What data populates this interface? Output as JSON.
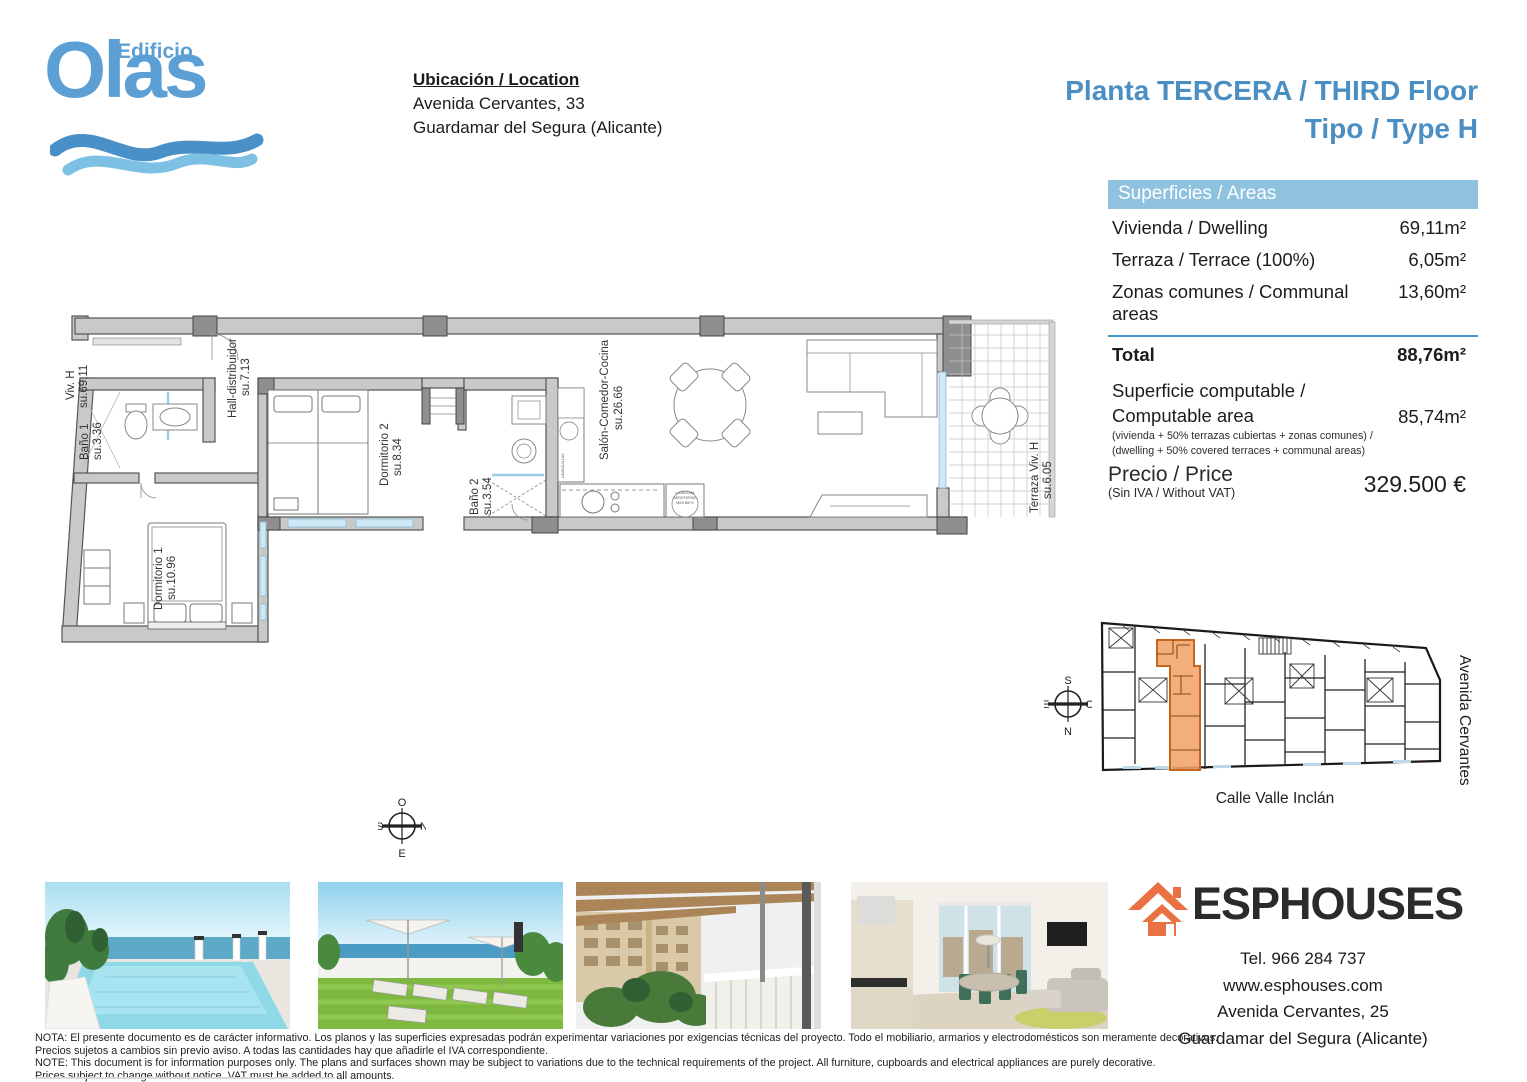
{
  "colors": {
    "accent": "#4a8ec2",
    "table_header": "#8fc2de",
    "divider": "#3f9ac9",
    "orange": "#ea7242",
    "site_highlight": "#f1a469",
    "logo_blue": "#5b9fd4",
    "wave_light": "#7cc0e4"
  },
  "logo": {
    "top": "Edificio",
    "main": "Olas"
  },
  "location": {
    "heading": "Ubicación / Location",
    "line1": "Avenida Cervantes, 33",
    "line2": "Guardamar del Segura (Alicante)"
  },
  "title": {
    "line1": "Planta TERCERA / THIRD Floor",
    "line2": "Tipo / Type H"
  },
  "areas": {
    "header": "Superficies / Areas",
    "rows": [
      {
        "label": "Vivienda / Dwelling",
        "value": "69,11m²"
      },
      {
        "label": "Terraza / Terrace (100%)",
        "value": "6,05m²"
      },
      {
        "label": "Zonas comunes / Communal areas",
        "value": "13,60m²"
      }
    ],
    "total": {
      "label": "Total",
      "value": "88,76m²"
    },
    "computable": {
      "label1": "Superficie computable /",
      "label2": "Computable area",
      "note1": "(vivienda + 50% terrazas cubiertas + zonas comunes) /",
      "note2": "(dwelling + 50% covered terraces + communal areas)",
      "value": "85,74m²"
    }
  },
  "price": {
    "label": "Precio / Price",
    "note": "(Sin IVA / Without VAT)",
    "value": "329.500 €"
  },
  "floorplan": {
    "labels": {
      "viv": "Viv. H",
      "viv_su": "su.69.11",
      "bano1": "Baño 1",
      "bano1_su": "su.3.36",
      "hall": "Hall-distribuidor",
      "hall_su": "su.7.13",
      "dorm1": "Dormitorio 1",
      "dorm1_su": "su.10.96",
      "dorm2": "Dormitorio 2",
      "dorm2_su": "su.8.34",
      "bano2": "Baño 2",
      "bano2_su": "su.3.54",
      "salon": "Salón-Comedor-Cocina",
      "salon_su": "su.26.66",
      "terraza": "Terraza Viv. H",
      "terraza_su": "su.6.05",
      "aero1": "LAVADORA",
      "aero2": "AEROTERMO",
      "aero3": "MINI BIE K",
      "lavavajillas": "LAVAVAJILLAS"
    },
    "compass": {
      "top": "O",
      "left": "S",
      "right": "N",
      "bottom": "E"
    }
  },
  "siteplan": {
    "street_bottom": "Calle Valle Inclán",
    "street_right": "Avenida Cervantes",
    "compass": {
      "top": "S",
      "left": "E",
      "right": "O",
      "bottom": "N"
    }
  },
  "agency": {
    "name": "ESPHOUSES",
    "tel": "Tel. 966 284 737",
    "web": "www.esphouses.com",
    "address1": "Avenida Cervantes, 25",
    "address2": "Guardamar del Segura (Alicante)"
  },
  "disclaimer": [
    "NOTA: El presente documento es de carácter informativo. Los planos y las superficies expresadas podrán experimentar variaciones por exigencias técnicas del proyecto. Todo el mobiliario, armarios y electrodomésticos son meramente decorativos.",
    "Precios sujetos a cambios sin previo aviso. A todas las cantidades hay que añadirle el IVA correspondiente.",
    "NOTE: This document is for information purposes only. The plans and surfaces shown may be subject to variations due to the technical requirements of the project. All furniture, cupboards and electrical appliances are purely decorative.",
    "Prices subject to change without notice. VAT must be added to all amounts."
  ]
}
